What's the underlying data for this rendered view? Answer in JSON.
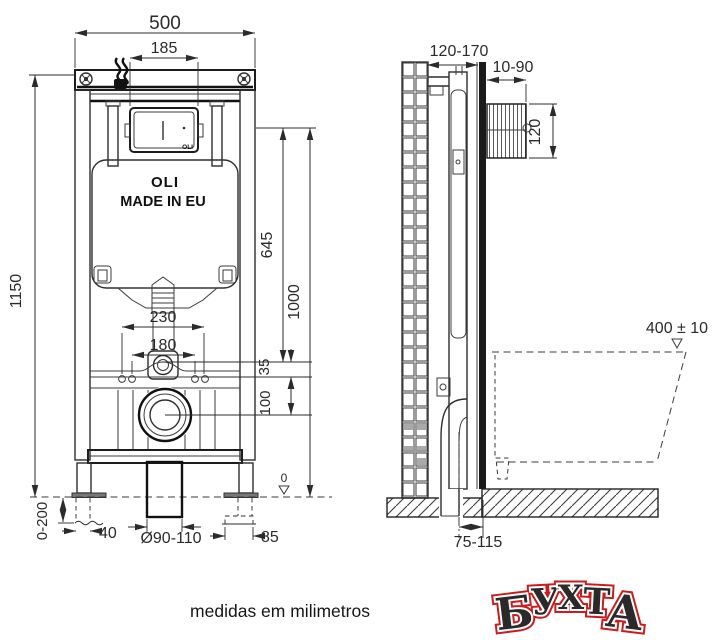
{
  "drawing": {
    "caption": "medidas em milimetros",
    "watermark": {
      "color": "#ce1a1a",
      "letters": [
        "Б",
        "У",
        "Х",
        "Т",
        "А"
      ]
    },
    "front_view": {
      "brand_plate": "OLI",
      "brand_tank": "OLI",
      "made_in": "MADE IN EU",
      "dims": {
        "overall_width": "500",
        "plate_width": "185",
        "overall_height": "1150",
        "plate_axis_height": "645",
        "top_edge_height": "1000",
        "fixing_span_outer": "230",
        "fixing_span_inner": "180",
        "inlet_offset": "35",
        "drain_axis": "100",
        "feet_adjust": "0-200",
        "foot_width": "40",
        "drain_diameter": "Ø90-110",
        "bracket_depth": "85",
        "floor_datum": "0"
      }
    },
    "side_view": {
      "dims": {
        "install_depth": "120-170",
        "finish_thickness": "10-90",
        "sleeve_height": "120",
        "bowl_height": "400 ± 10",
        "drain_to_wall": "75-115"
      }
    }
  }
}
